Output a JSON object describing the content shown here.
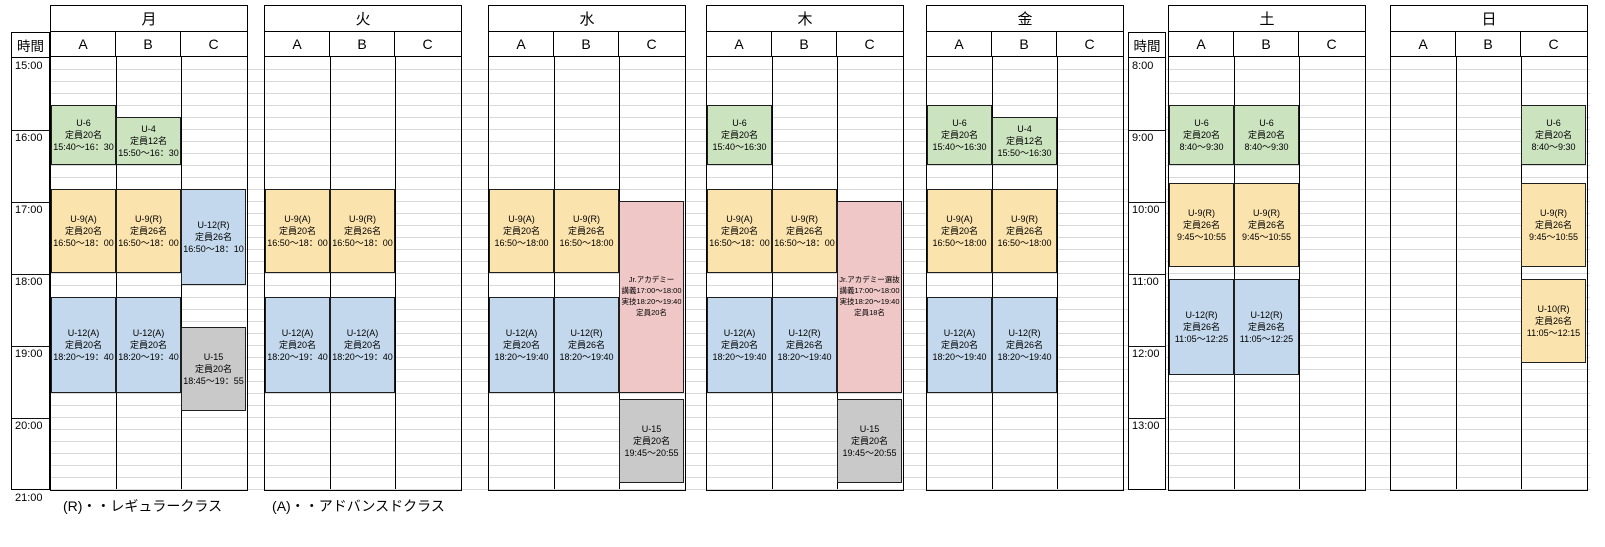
{
  "time_axes": {
    "left": {
      "header": "時間",
      "start": "15:00",
      "labels": [
        "15:00",
        "16:00",
        "17:00",
        "18:00",
        "19:00",
        "20:00",
        "21:00"
      ]
    },
    "right": {
      "header": "時間",
      "start": "8:00",
      "labels": [
        "8:00",
        "9:00",
        "10:00",
        "11:00",
        "12:00",
        "13:00"
      ]
    }
  },
  "column_labels": [
    "A",
    "B",
    "C"
  ],
  "legend": {
    "regular": "(R)・・レギュラークラス",
    "advanced": "(A)・・アドバンスドクラス"
  },
  "colors": {
    "green": "#cbe3bf",
    "yellow": "#fbe3ad",
    "blue": "#c3d8ec",
    "pink": "#f0c7c7",
    "gray": "#c9c9c9"
  },
  "days": [
    {
      "id": "mon",
      "name": "月",
      "axis": "left",
      "events": [
        {
          "col": "A",
          "color": "green",
          "start": "15:40",
          "end": "16:30",
          "lines": [
            "U-6",
            "定員20名",
            "15:40～16：30"
          ]
        },
        {
          "col": "B",
          "color": "green",
          "start": "15:50",
          "end": "16:30",
          "lines": [
            "U-4",
            "定員12名",
            "15:50～16：30"
          ]
        },
        {
          "col": "A",
          "color": "yellow",
          "start": "16:50",
          "end": "18:00",
          "lines": [
            "U-9(A)",
            "定員20名",
            "16:50～18：00"
          ]
        },
        {
          "col": "B",
          "color": "yellow",
          "start": "16:50",
          "end": "18:00",
          "lines": [
            "U-9(R)",
            "定員26名",
            "16:50～18：00"
          ]
        },
        {
          "col": "C",
          "color": "blue",
          "start": "16:50",
          "end": "18:10",
          "lines": [
            "U-12(R)",
            "定員26名",
            "16:50～18：10"
          ]
        },
        {
          "col": "A",
          "color": "blue",
          "start": "18:20",
          "end": "19:40",
          "lines": [
            "U-12(A)",
            "定員20名",
            "18:20～19：40"
          ]
        },
        {
          "col": "B",
          "color": "blue",
          "start": "18:20",
          "end": "19:40",
          "lines": [
            "U-12(A)",
            "定員20名",
            "18:20～19：40"
          ]
        },
        {
          "col": "C",
          "color": "gray",
          "start": "18:45",
          "end": "19:55",
          "lines": [
            "U-15",
            "定員20名",
            "18:45～19：55"
          ]
        }
      ]
    },
    {
      "id": "tue",
      "name": "火",
      "axis": "left",
      "events": [
        {
          "col": "A",
          "color": "yellow",
          "start": "16:50",
          "end": "18:00",
          "lines": [
            "U-9(A)",
            "定員20名",
            "16:50～18：00"
          ]
        },
        {
          "col": "B",
          "color": "yellow",
          "start": "16:50",
          "end": "18:00",
          "lines": [
            "U-9(R)",
            "定員26名",
            "16:50～18：00"
          ]
        },
        {
          "col": "A",
          "color": "blue",
          "start": "18:20",
          "end": "19:40",
          "lines": [
            "U-12(A)",
            "定員20名",
            "18:20～19：40"
          ]
        },
        {
          "col": "B",
          "color": "blue",
          "start": "18:20",
          "end": "19:40",
          "lines": [
            "U-12(A)",
            "定員20名",
            "18:20～19：40"
          ]
        }
      ]
    },
    {
      "id": "wed",
      "name": "水",
      "axis": "left",
      "events": [
        {
          "col": "A",
          "color": "yellow",
          "start": "16:50",
          "end": "18:00",
          "lines": [
            "U-9(A)",
            "定員20名",
            "16:50～18:00"
          ]
        },
        {
          "col": "B",
          "color": "yellow",
          "start": "16:50",
          "end": "18:00",
          "lines": [
            "U-9(R)",
            "定員26名",
            "16:50～18:00"
          ]
        },
        {
          "col": "C",
          "color": "pink",
          "start": "17:00",
          "end": "19:40",
          "small": true,
          "lines": [
            "Jr.アカデミー",
            "講義17:00～18:00",
            "実技18:20～19:40",
            "定員20名"
          ]
        },
        {
          "col": "A",
          "color": "blue",
          "start": "18:20",
          "end": "19:40",
          "lines": [
            "U-12(A)",
            "定員20名",
            "18:20～19:40"
          ]
        },
        {
          "col": "B",
          "color": "blue",
          "start": "18:20",
          "end": "19:40",
          "lines": [
            "U-12(R)",
            "定員26名",
            "18:20～19:40"
          ]
        },
        {
          "col": "C",
          "color": "gray",
          "start": "19:45",
          "end": "20:55",
          "lines": [
            "U-15",
            "定員20名",
            "19:45～20:55"
          ]
        }
      ]
    },
    {
      "id": "thu",
      "name": "木",
      "axis": "left",
      "events": [
        {
          "col": "A",
          "color": "green",
          "start": "15:40",
          "end": "16:30",
          "lines": [
            "U-6",
            "定員20名",
            "15:40～16:30"
          ]
        },
        {
          "col": "A",
          "color": "yellow",
          "start": "16:50",
          "end": "18:00",
          "lines": [
            "U-9(A)",
            "定員20名",
            "16:50～18：00"
          ]
        },
        {
          "col": "B",
          "color": "yellow",
          "start": "16:50",
          "end": "18:00",
          "lines": [
            "U-9(R)",
            "定員26名",
            "16:50～18：00"
          ]
        },
        {
          "col": "C",
          "color": "pink",
          "start": "17:00",
          "end": "19:40",
          "small": true,
          "lines": [
            "Jr.アカデミー選抜",
            "講義17:00～18:00",
            "実技18:20～19:40",
            "定員18名"
          ]
        },
        {
          "col": "A",
          "color": "blue",
          "start": "18:20",
          "end": "19:40",
          "lines": [
            "U-12(A)",
            "定員20名",
            "18:20～19:40"
          ]
        },
        {
          "col": "B",
          "color": "blue",
          "start": "18:20",
          "end": "19:40",
          "lines": [
            "U-12(R)",
            "定員26名",
            "18:20～19:40"
          ]
        },
        {
          "col": "C",
          "color": "gray",
          "start": "19:45",
          "end": "20:55",
          "lines": [
            "U-15",
            "定員20名",
            "19:45～20:55"
          ]
        }
      ]
    },
    {
      "id": "fri",
      "name": "金",
      "axis": "left",
      "events": [
        {
          "col": "A",
          "color": "green",
          "start": "15:40",
          "end": "16:30",
          "lines": [
            "U-6",
            "定員20名",
            "15:40～16:30"
          ]
        },
        {
          "col": "B",
          "color": "green",
          "start": "15:50",
          "end": "16:30",
          "lines": [
            "U-4",
            "定員12名",
            "15:50～16:30"
          ]
        },
        {
          "col": "A",
          "color": "yellow",
          "start": "16:50",
          "end": "18:00",
          "lines": [
            "U-9(A)",
            "定員20名",
            "16:50～18:00"
          ]
        },
        {
          "col": "B",
          "color": "yellow",
          "start": "16:50",
          "end": "18:00",
          "lines": [
            "U-9(R)",
            "定員26名",
            "16:50～18:00"
          ]
        },
        {
          "col": "A",
          "color": "blue",
          "start": "18:20",
          "end": "19:40",
          "lines": [
            "U-12(A)",
            "定員20名",
            "18:20～19:40"
          ]
        },
        {
          "col": "B",
          "color": "blue",
          "start": "18:20",
          "end": "19:40",
          "lines": [
            "U-12(R)",
            "定員26名",
            "18:20～19:40"
          ]
        }
      ]
    },
    {
      "id": "sat",
      "name": "土",
      "axis": "right",
      "events": [
        {
          "col": "A",
          "color": "green",
          "start": "8:40",
          "end": "9:30",
          "lines": [
            "U-6",
            "定員20名",
            "8:40～9:30"
          ]
        },
        {
          "col": "B",
          "color": "green",
          "start": "8:40",
          "end": "9:30",
          "lines": [
            "U-6",
            "定員20名",
            "8:40～9:30"
          ]
        },
        {
          "col": "A",
          "color": "yellow",
          "start": "9:45",
          "end": "10:55",
          "lines": [
            "U-9(R)",
            "定員26名",
            "9:45～10:55"
          ]
        },
        {
          "col": "B",
          "color": "yellow",
          "start": "9:45",
          "end": "10:55",
          "lines": [
            "U-9(R)",
            "定員26名",
            "9:45～10:55"
          ]
        },
        {
          "col": "A",
          "color": "blue",
          "start": "11:05",
          "end": "12:25",
          "lines": [
            "U-12(R)",
            "定員26名",
            "11:05～12:25"
          ]
        },
        {
          "col": "B",
          "color": "blue",
          "start": "11:05",
          "end": "12:25",
          "lines": [
            "U-12(R)",
            "定員26名",
            "11:05～12:25"
          ]
        }
      ]
    },
    {
      "id": "sun",
      "name": "日",
      "axis": "right",
      "events": [
        {
          "col": "C",
          "color": "green",
          "start": "8:40",
          "end": "9:30",
          "lines": [
            "U-6",
            "定員20名",
            "8:40～9:30"
          ]
        },
        {
          "col": "C",
          "color": "yellow",
          "start": "9:45",
          "end": "10:55",
          "lines": [
            "U-9(R)",
            "定員26名",
            "9:45～10:55"
          ]
        },
        {
          "col": "C",
          "color": "yellow",
          "start": "11:05",
          "end": "12:15",
          "lines": [
            "U-10(R)",
            "定員26名",
            "11:05～12:15"
          ]
        }
      ]
    }
  ]
}
